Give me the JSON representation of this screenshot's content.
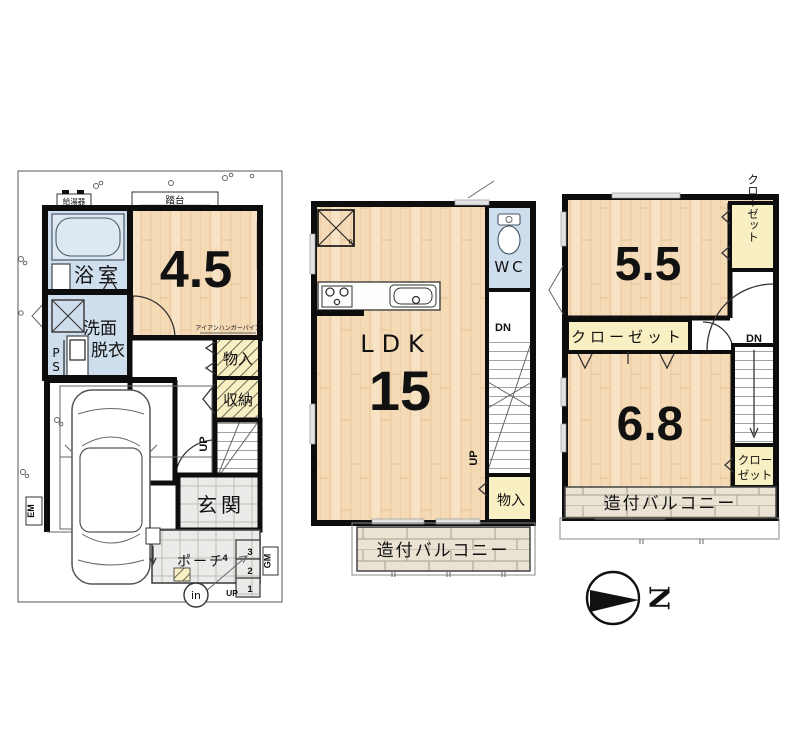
{
  "colors": {
    "wood": "#f5dab6",
    "water_blue": "#cfdeed",
    "closet_yellow": "#f8efc3",
    "tile_gray": "#ebebe9",
    "brick_beige": "#eae3d3",
    "wall_black": "#0d0d0d"
  },
  "f1": {
    "water_heater": "給湯器",
    "step_platform": "踏台",
    "bath": "浴室",
    "room_size": "4.5",
    "hanger_pipe": "アイアンハンガーパイプ",
    "wash_line1": "洗面",
    "wash_line2": "脱衣",
    "ps_line1": "P",
    "ps_line2": "S",
    "storage_a": "物入",
    "storage_b": "収納",
    "stairs_up": "UP",
    "entrance": "玄関",
    "porch": "ポーチ",
    "step_3": "3",
    "step_2": "2",
    "step_1": "1",
    "step_4": "4",
    "porch_up": "UP",
    "intercom": "in",
    "em": "EM",
    "gm": "GM"
  },
  "f2": {
    "fridge": "R",
    "wc": "WC",
    "ldk": "LDK",
    "ldk_size": "15",
    "dn": "DN",
    "up": "UP",
    "storage": "物入",
    "balcony": "造付バルコニー"
  },
  "f3": {
    "room_a_size": "5.5",
    "closet_right": "クローゼット",
    "closet_mid": "クローゼット",
    "room_b_size": "6.8",
    "dn": "DN",
    "closet_small_line1": "クロー",
    "closet_small_line2": "ゼット",
    "balcony": "造付バルコニー"
  },
  "compass": {
    "north": "N"
  }
}
